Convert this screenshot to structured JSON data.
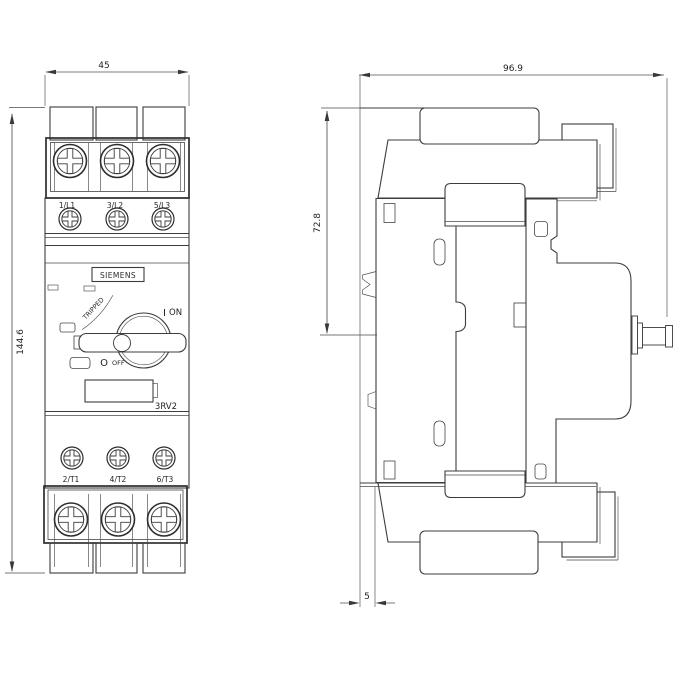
{
  "drawing": {
    "front_view": {
      "brand": "SIEMENS",
      "model": "3RV2",
      "tripped_label": "TRIPPED",
      "on_symbol": "I",
      "on_label": "ON",
      "off_symbol": "O",
      "off_label": "OFF",
      "top_terminals": [
        "1/L1",
        "3/L2",
        "5/L3"
      ],
      "bottom_terminals": [
        "2/T1",
        "4/T2",
        "6/T3"
      ],
      "dimensions": {
        "width_mm": "45",
        "height_mm": "144.6"
      }
    },
    "side_view": {
      "dimensions": {
        "depth_mm": "96.9",
        "upper_height_mm": "72.8",
        "rail_offset_mm": "5"
      }
    },
    "line_color": "#3c3c3c",
    "background": "#ffffff"
  }
}
